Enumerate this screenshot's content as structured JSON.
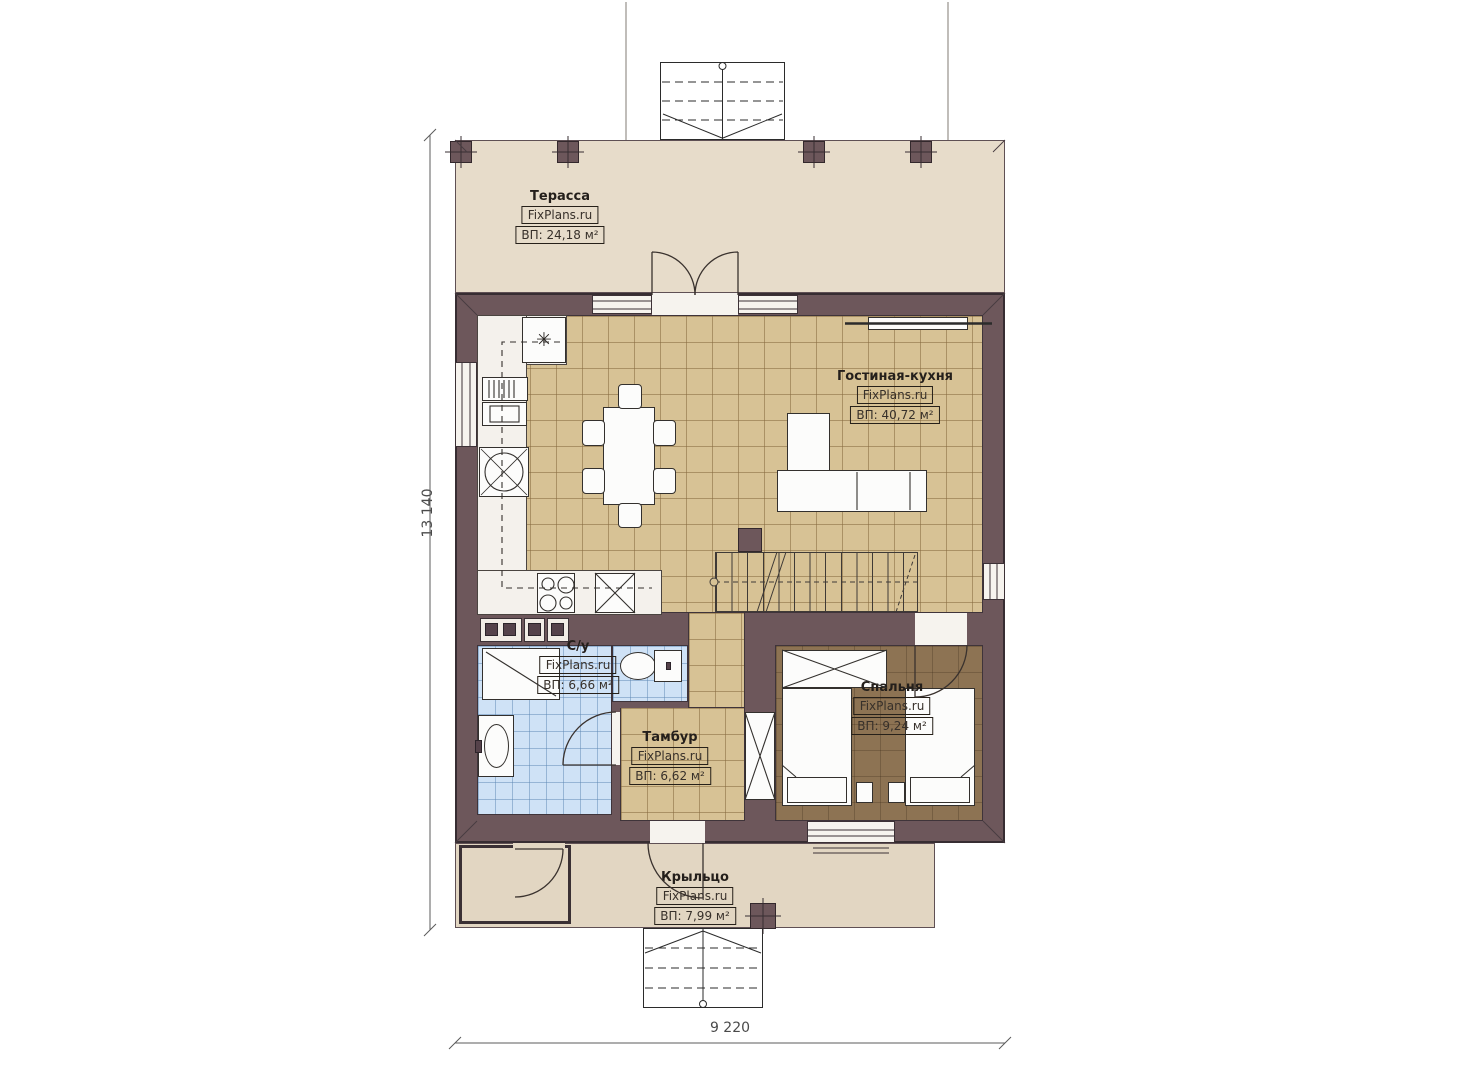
{
  "watermark": "FixPlans.ru",
  "rooms": {
    "terrace": {
      "name": "Терасса",
      "area": "ВП: 24,18 м²"
    },
    "living_kitchen": {
      "name": "Гостиная-кухня",
      "area": "ВП: 40,72 м²"
    },
    "bathroom": {
      "name": "С/у",
      "area": "ВП: 6,66 м²"
    },
    "vestibule": {
      "name": "Тамбур",
      "area": "ВП: 6,62 м²"
    },
    "bedroom": {
      "name": "Спальня",
      "area": "ВП: 9,24 м²"
    },
    "porch": {
      "name": "Крыльцо",
      "area": "ВП: 7,99 м²"
    }
  },
  "dimensions": {
    "height": "13 140",
    "width": "9 220"
  },
  "icons": {
    "fridge_snowflake": "✳"
  },
  "colors": {
    "wall": "#6d575b",
    "floor_tile": "#d7c295",
    "floor_bath": "#cfe2f6",
    "floor_bedroom": "#8d7353",
    "outdoor": "#e7dcca"
  }
}
